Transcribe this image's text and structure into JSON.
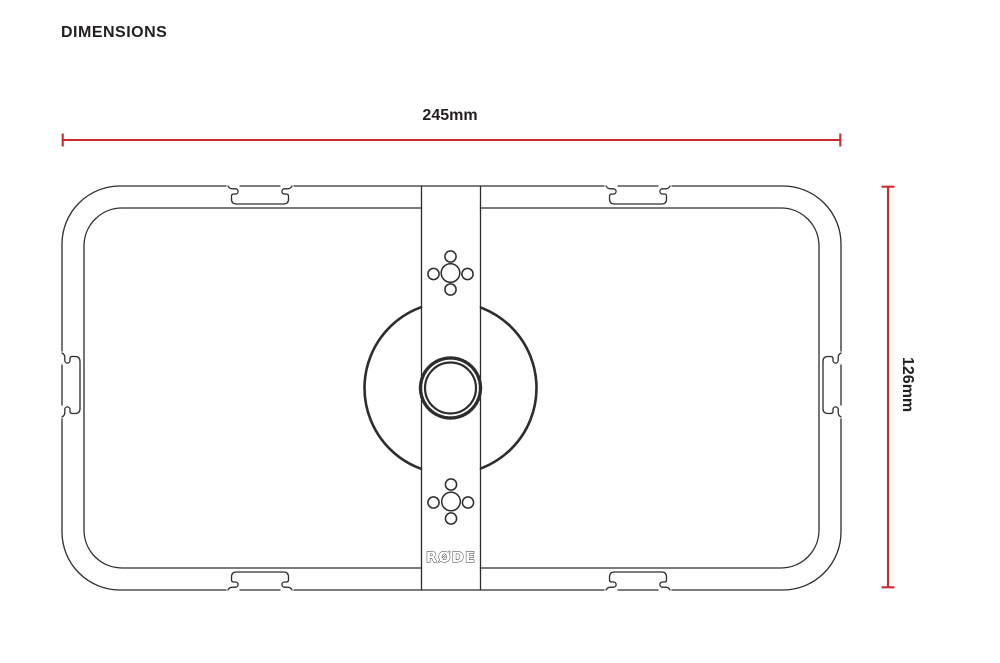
{
  "page": {
    "title": "DIMENSIONS"
  },
  "dimensions": {
    "width_label": "245mm",
    "height_label": "126mm",
    "line_color": "#cb2a30"
  },
  "drawing": {
    "logo": "RØDE",
    "line_color": "#2d2d2d"
  }
}
